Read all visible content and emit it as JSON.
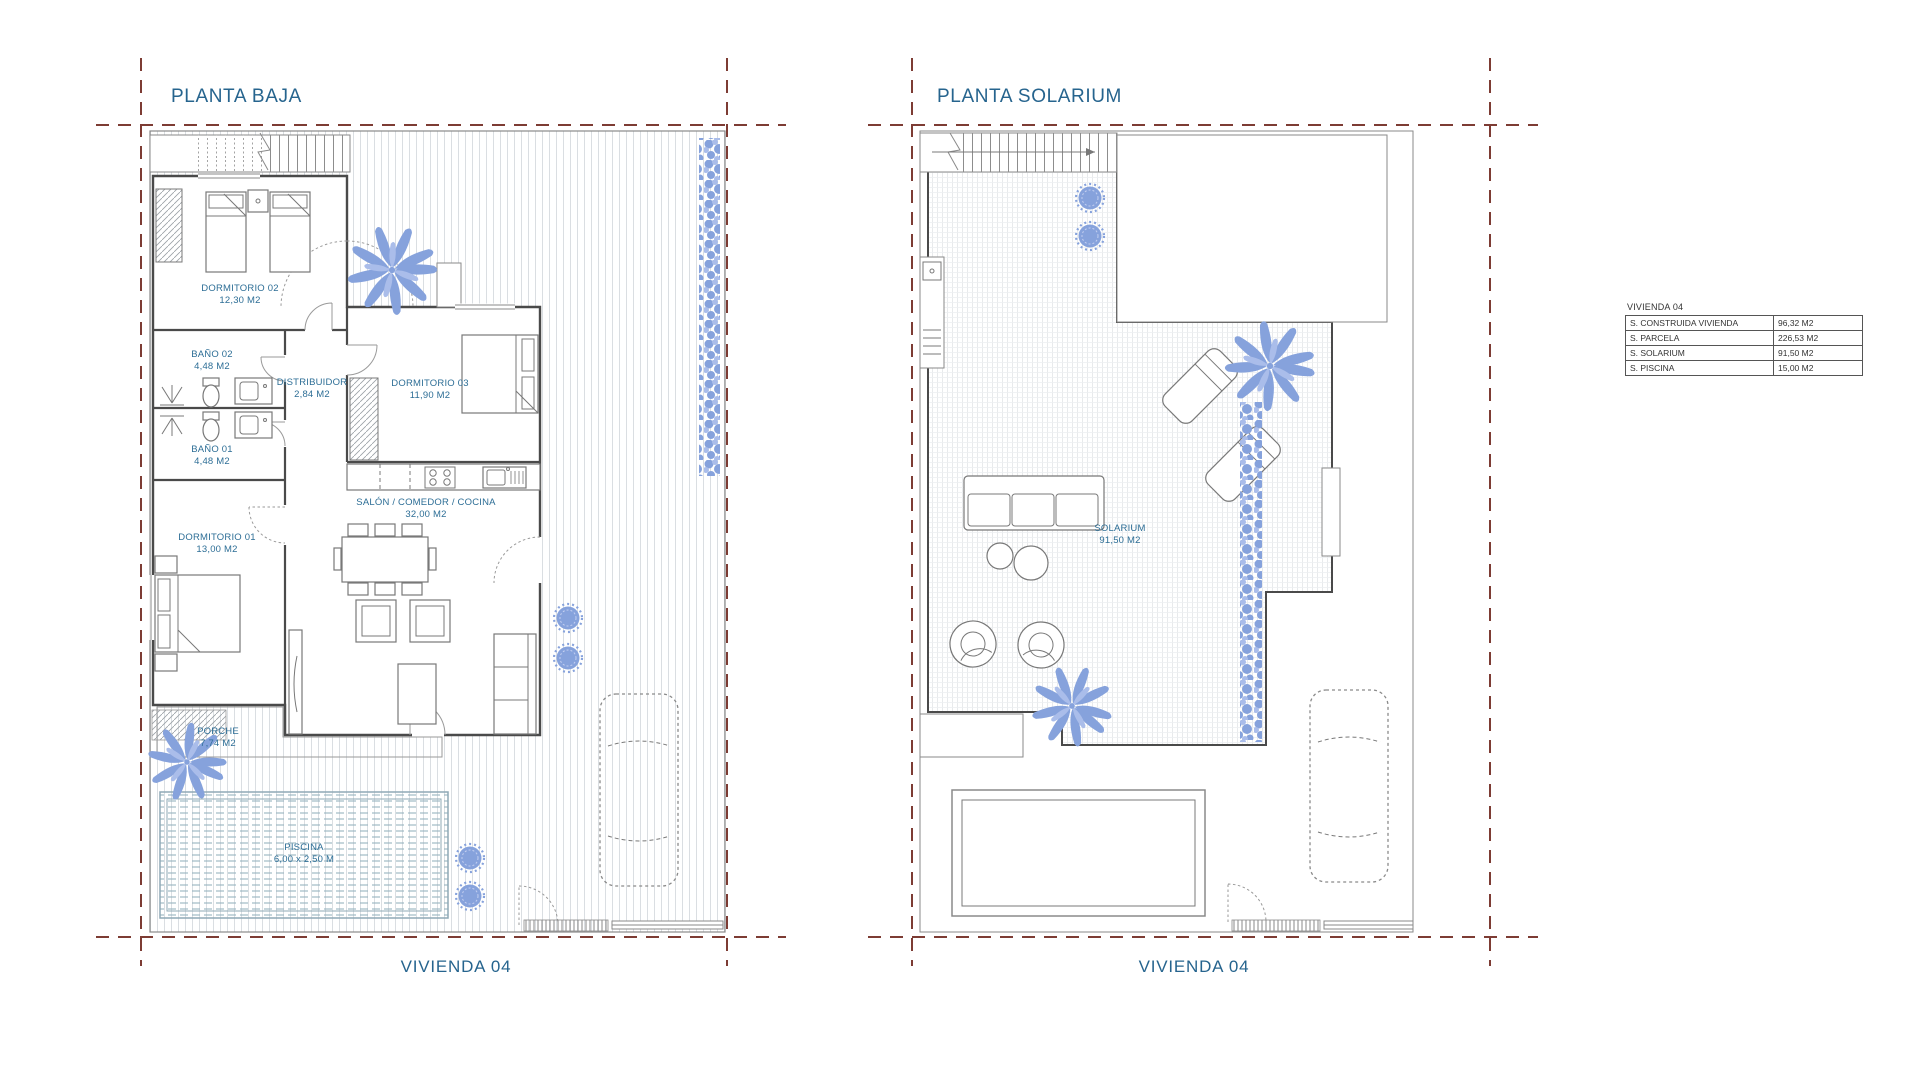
{
  "colors": {
    "label_blue": "#2d6e96",
    "title_blue": "#26648e",
    "boundary_red": "#7d3c34",
    "plant_blue": "#86a2dc",
    "plant_blue_light": "#aabdea",
    "wall_gray": "#4a4a4a",
    "furn_gray": "#787878",
    "pool_teal": "#8fa9b6",
    "line_gray": "#8a8a8a"
  },
  "left_plan": {
    "title": "PLANTA BAJA",
    "footer": "VIVIENDA 04",
    "rooms": [
      {
        "name": "DORMITORIO 02",
        "area": "12,30 M2"
      },
      {
        "name": "BAÑO 02",
        "area": "4,48 M2"
      },
      {
        "name": "DISTRIBUIDOR",
        "area": "2,84 M2"
      },
      {
        "name": "DORMITORIO 03",
        "area": "11,90 M2"
      },
      {
        "name": "BAÑO 01",
        "area": "4,48 M2"
      },
      {
        "name": "DORMITORIO 01",
        "area": "13,00 M2"
      },
      {
        "name": "SALÓN / COMEDOR / COCINA",
        "area": "32,00 M2"
      },
      {
        "name": "PORCHE",
        "area": "7,74 M2"
      },
      {
        "name": "PISCINA",
        "area": "6,00 x 2,50 M"
      }
    ]
  },
  "right_plan": {
    "title": "PLANTA SOLARIUM",
    "footer": "VIVIENDA 04",
    "rooms": [
      {
        "name": "SOLARIUM",
        "area": "91,50 M2"
      }
    ]
  },
  "summary_table": {
    "title": "VIVIENDA 04",
    "rows": [
      {
        "label": "S. CONSTRUIDA VIVIENDA",
        "value": "96,32 M2"
      },
      {
        "label": "S. PARCELA",
        "value": "226,53 M2"
      },
      {
        "label": "S. SOLARIUM",
        "value": "91,50 M2"
      },
      {
        "label": "S. PISCINA",
        "value": "15,00 M2"
      }
    ]
  }
}
